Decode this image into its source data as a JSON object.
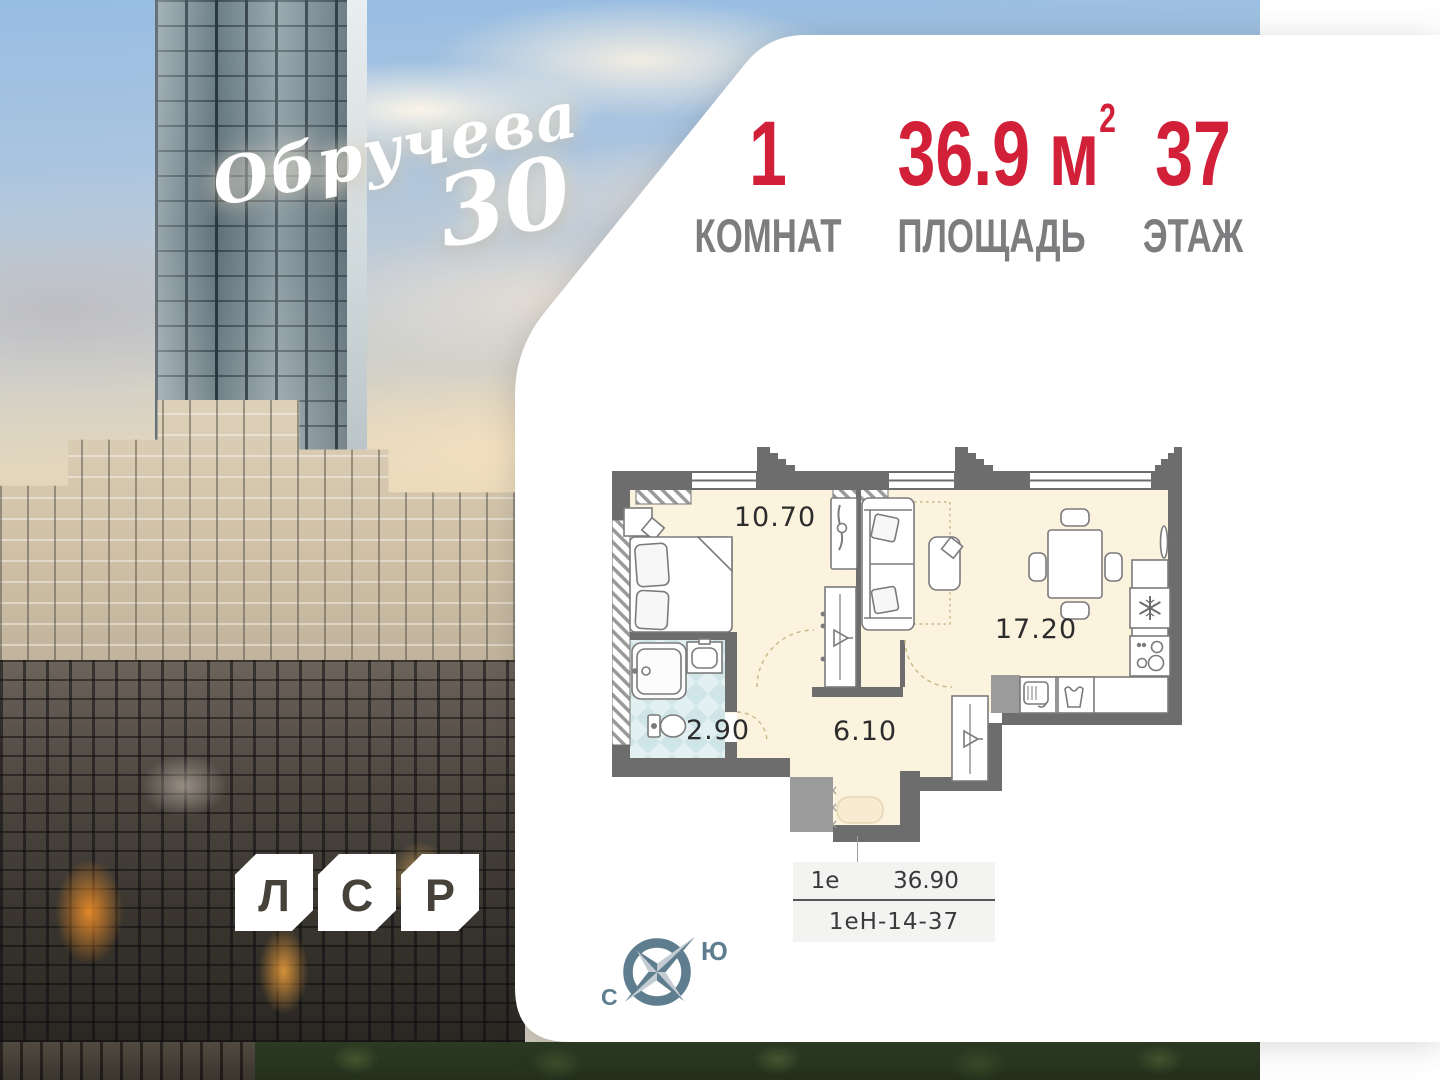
{
  "project": {
    "script_name": "Обручева",
    "number": "30"
  },
  "developer": {
    "letters": [
      "Л",
      "С",
      "Р"
    ]
  },
  "header": {
    "stats": [
      {
        "value": "1",
        "label": "КОМНАТ"
      },
      {
        "value": "36.9 м",
        "sup": "2",
        "label": "ПЛОЩАДЬ"
      },
      {
        "value": "37",
        "label": "ЭТАЖ"
      }
    ]
  },
  "floorplan": {
    "rooms": [
      {
        "area": "10.70"
      },
      {
        "area": "17.20"
      },
      {
        "area": "2.90"
      },
      {
        "area": "6.10"
      }
    ]
  },
  "info_table": {
    "unit_type": "1е",
    "area": "36.90",
    "code": "1еН-14-37"
  },
  "compass": {
    "south": "Ю",
    "north": "С"
  },
  "colors": {
    "accent_red": "#d32039",
    "label_gray": "#7d7d80",
    "wall_gray": "#6d6d6d",
    "floor_cream": "#fcf3df",
    "tile_blue": "#cfe5e8",
    "compass_slate": "#5e7d8e"
  }
}
